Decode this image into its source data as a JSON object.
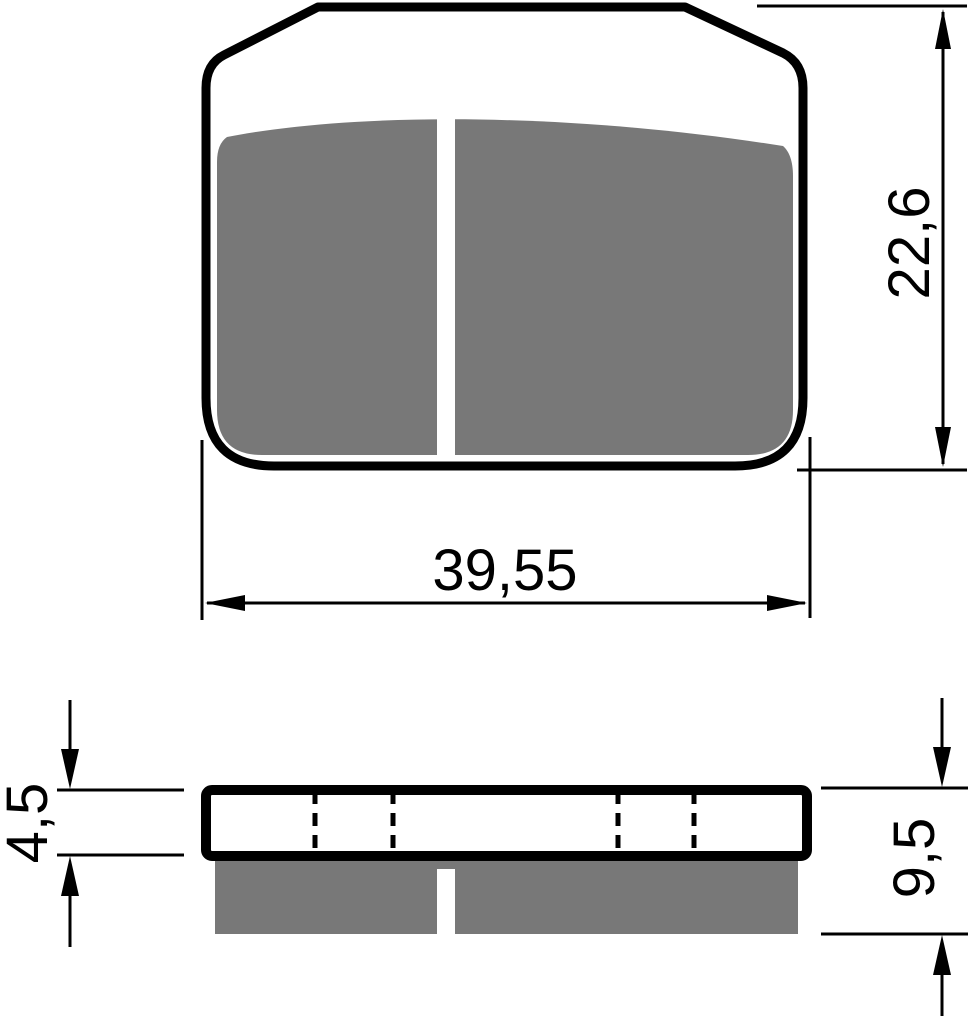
{
  "drawing": {
    "subject": "brake-pad-technical-drawing",
    "background_color": "#ffffff",
    "line_color": "#000000",
    "friction_material_color": "#787878",
    "top_view": {
      "width_dim": "39,55",
      "height_dim": "22,6"
    },
    "side_view": {
      "plate_thickness_dim": "4,5",
      "total_thickness_dim": "9,5"
    }
  }
}
